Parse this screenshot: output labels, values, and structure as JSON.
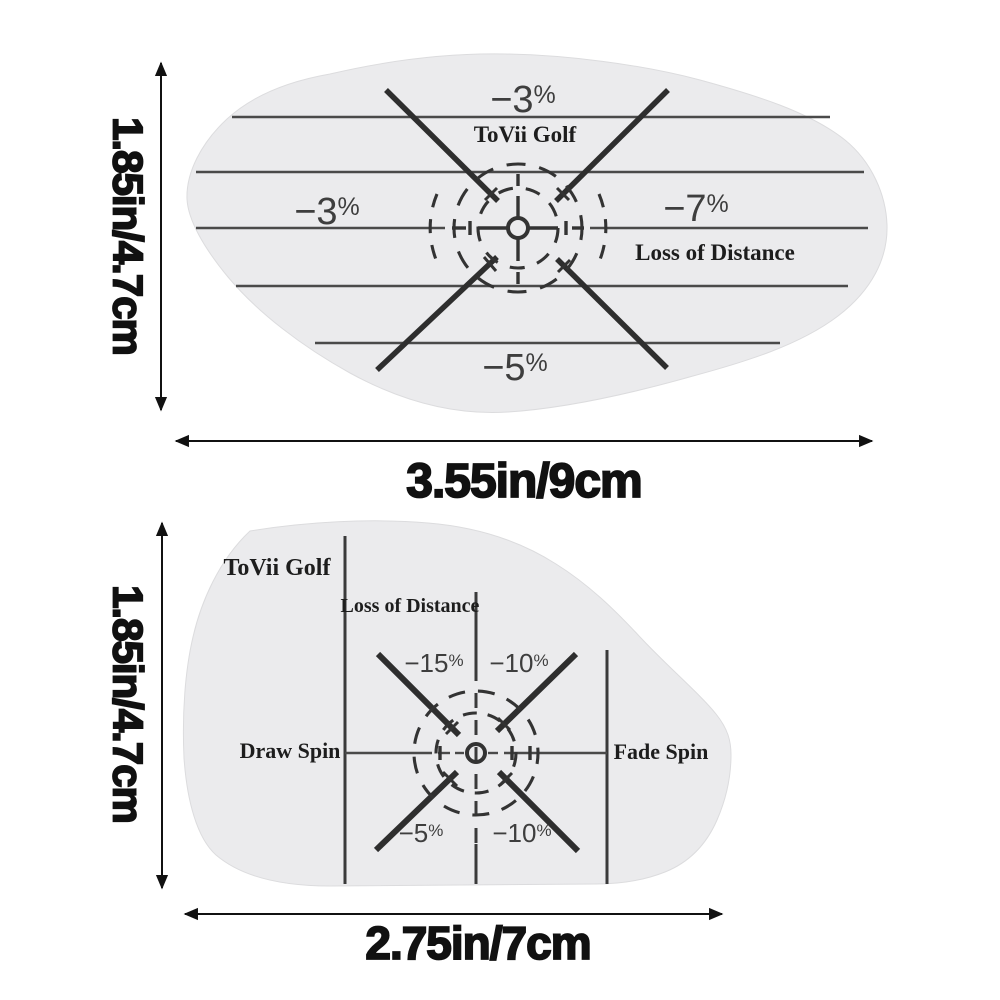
{
  "top_sticker": {
    "brand": "ToVii Golf",
    "loss_caption": "Loss of Distance",
    "pct_top": {
      "num": "−3",
      "sym": "%"
    },
    "pct_left": {
      "num": "−3",
      "sym": "%"
    },
    "pct_right": {
      "num": "−7",
      "sym": "%"
    },
    "pct_bottom": {
      "num": "−5",
      "sym": "%"
    },
    "height_label": "1.85in/4.7cm",
    "width_label": "3.55in/9cm"
  },
  "bottom_sticker": {
    "brand": "ToVii Golf",
    "loss_caption": "Loss of Distance",
    "draw_label": "Draw Spin",
    "fade_label": "Fade Spin",
    "pct_upper_left": {
      "num": "−15",
      "sym": "%"
    },
    "pct_upper_right": {
      "num": "−10",
      "sym": "%"
    },
    "pct_lower_left": {
      "num": "−5",
      "sym": "%"
    },
    "pct_lower_right": {
      "num": "−10",
      "sym": "%"
    },
    "height_label": "1.85in/4.7cm",
    "width_label": "2.75in/7cm"
  },
  "colors": {
    "sticker_fill": "#ebebed",
    "ink": "#2e2e2e",
    "line": "#4a4a4a",
    "dim_ink": "#111111",
    "page_bg": "#ffffff"
  }
}
